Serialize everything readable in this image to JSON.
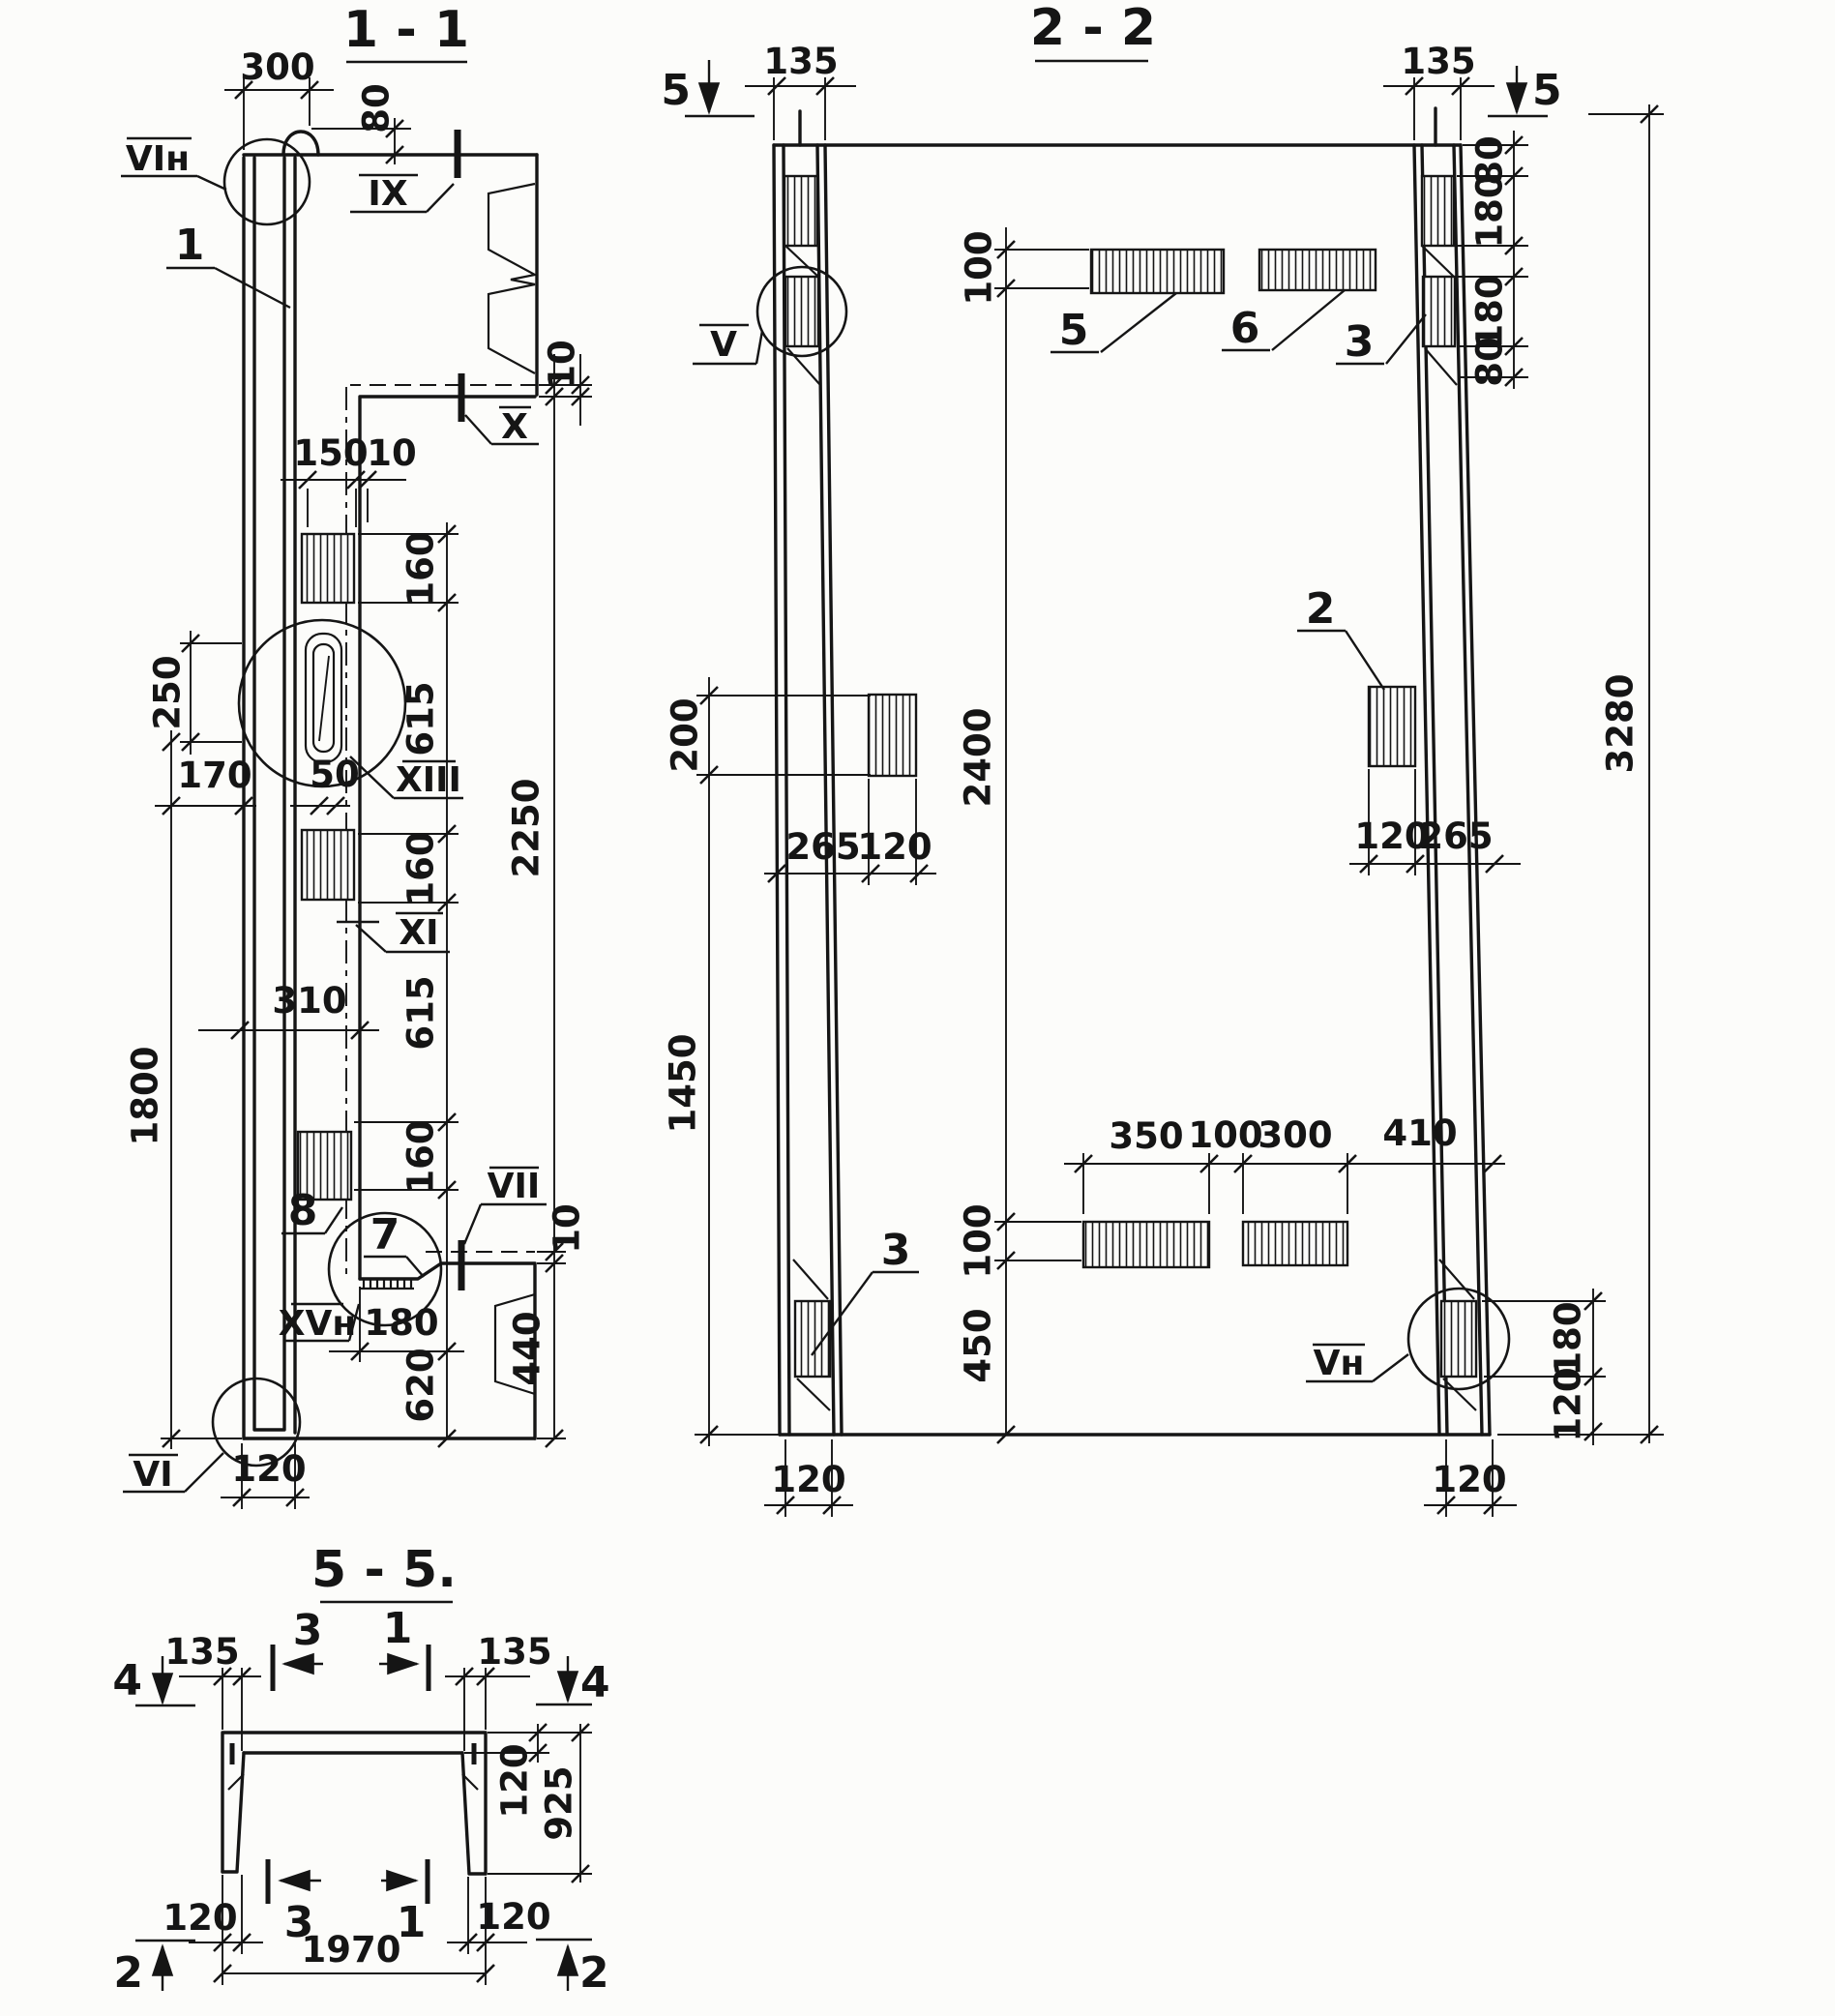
{
  "colors": {
    "ink": "#151515",
    "paper": "#fcfcfa"
  },
  "s11": {
    "title": "1 - 1",
    "d300": "300",
    "d80": "80",
    "d10_top": "10",
    "d150": "150",
    "d10_mid": "10",
    "d160_1": "160",
    "d615_1": "615",
    "d160_2": "160",
    "d615_2": "615",
    "d160_3": "160",
    "d2250": "2250",
    "d250": "250",
    "d170": "170",
    "d50": "50",
    "d310": "310",
    "d1800": "1800",
    "d180": "180",
    "d620": "620",
    "d440": "440",
    "d10_bot": "10",
    "d120": "120",
    "m_vin": "VIн",
    "m_ix": "IX",
    "m_1": "1",
    "m_x": "X",
    "m_xiii": "XIII",
    "m_xi": "XI",
    "m_8": "8",
    "m_7": "7",
    "m_vii": "VII",
    "m_xvn": "XVн",
    "m_vi": "VI"
  },
  "s22": {
    "title": "2 - 2",
    "cut5_tl": "5",
    "cut5_tr": "5",
    "d135_l": "135",
    "d135_r": "135",
    "d80_1": "80",
    "d180_1": "180",
    "d180_2": "180",
    "d80_2": "80",
    "d3280": "3280",
    "d100_t": "100",
    "d2400": "2400",
    "d100_b": "100",
    "d450": "450",
    "d200": "200",
    "d1450": "1450",
    "d265_l": "265",
    "d120_l": "120",
    "d120_r": "120",
    "d265_r": "265",
    "d350": "350",
    "d100_r": "100",
    "d300": "300",
    "d410": "410",
    "d180_b": "180",
    "d120_b": "120",
    "d120_bl": "120",
    "d120_br": "120",
    "m_v": "V",
    "m_vn": "Vн",
    "m_5": "5",
    "m_6": "6",
    "m_3t": "3",
    "m_2": "2",
    "m_3b": "3"
  },
  "s55": {
    "title": "5 - 5.",
    "cut4_l": "4",
    "cut4_r": "4",
    "cut2_l": "2",
    "cut2_r": "2",
    "cut3_t": "3",
    "cut1_t": "1",
    "cut3_b": "3",
    "cut1_b": "1",
    "d135_l": "135",
    "d135_r": "135",
    "d120_slab": "120",
    "d925": "925",
    "d120_bl": "120",
    "d120_br": "120",
    "d1970": "1970"
  }
}
